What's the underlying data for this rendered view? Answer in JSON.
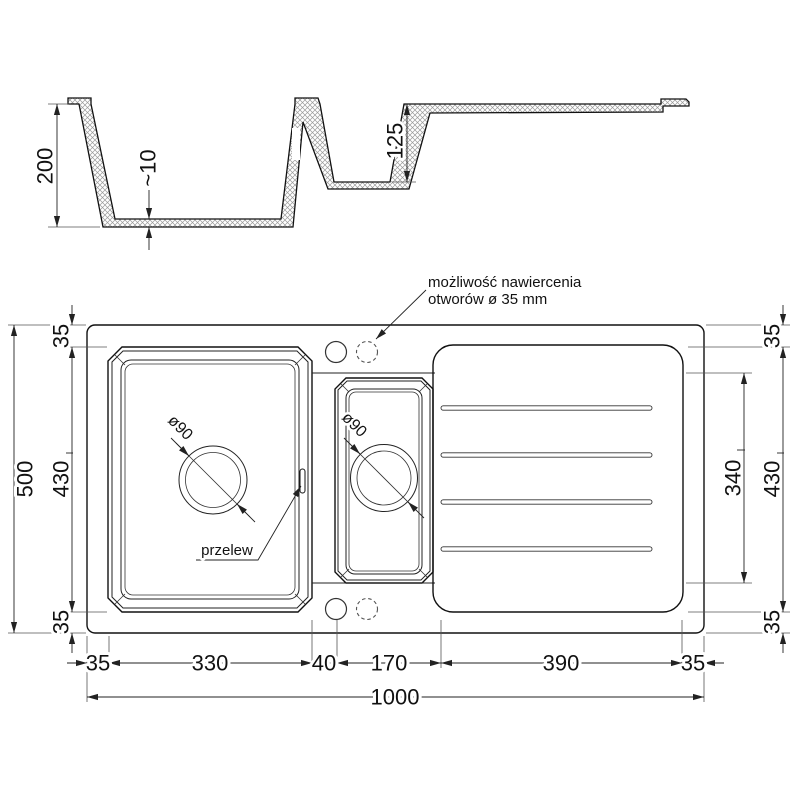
{
  "annotations": {
    "drill_note_line1": "możliwość nawiercenia",
    "drill_note_line2": "otworów ø 35 mm",
    "overflow": "przelew",
    "drain_main": "ø90",
    "drain_small": "ø90"
  },
  "section": {
    "depth_total": "200",
    "floor_thickness": "~10",
    "small_bowl_depth": "125"
  },
  "plan": {
    "overall_width": "1000",
    "overall_height": "500",
    "left_chain": [
      "35",
      "430",
      "35"
    ],
    "right_chain": [
      "35",
      "430",
      "35"
    ],
    "drainer_span": "340",
    "bottom_chain": [
      "35",
      "330",
      "40",
      "170",
      "390",
      "35"
    ]
  },
  "colors": {
    "line": "#111111",
    "dimension": "#222222",
    "extension": "#555555",
    "hatch": "#9a9a9a",
    "background": "#ffffff"
  }
}
